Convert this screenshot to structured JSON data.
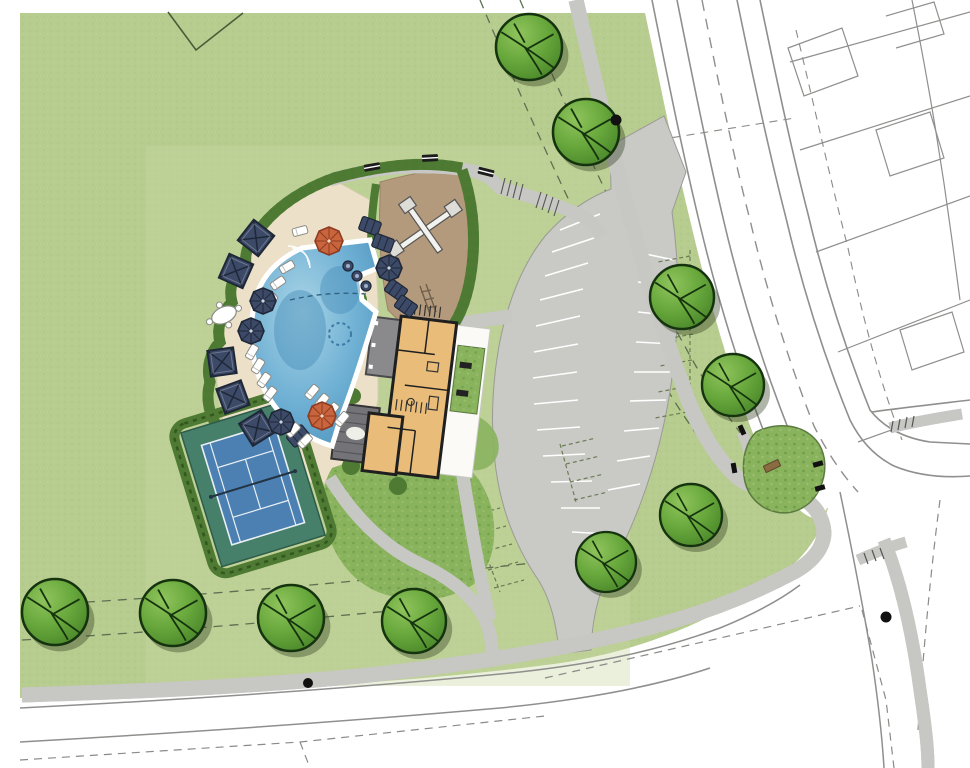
{
  "document": {
    "type": "color site plan rendering",
    "title": "Amenity center site plan",
    "visible_text": []
  },
  "colors": {
    "paper": "#ffffff",
    "grass": "#b7cc8f",
    "grass_light": "#c9d8a4",
    "grass_speckle": "#9fb377",
    "mound": "#8ab35e",
    "mound_dark": "#5e8e3a",
    "hedge": "#4e7a33",
    "hedge_dark": "#2c4f1a",
    "tree_fill": "#68a83c",
    "tree_light": "#8fc45c",
    "tree_dark": "#4d8a2c",
    "tree_outline": "#16330f",
    "tree_shadow": "rgba(45,60,30,0.38)",
    "deck": "#ece1c8",
    "mulch": "#b49a7c",
    "pool_light": "#a9d4e6",
    "pool_mid": "#6fb0d4",
    "pool_dark": "#4e93bd",
    "coping": "#ffffff",
    "parking": "#c9c9c6",
    "stripe": "#ffffff",
    "stall_dash": "#6b7c55",
    "road_line": "#8f8f8d",
    "walk": "#fbfaf6",
    "walk_edge": "#c7c7c3",
    "walk_dot": "#8f8f88",
    "floor": "#e9bd79",
    "wall": "#1f1f1f",
    "roof_gray": "#8a8a8c",
    "pergola_gray": "#737378",
    "navy": "#3c4a68",
    "navy_dark": "#1f2838",
    "orange": "#c9653c",
    "orange_dark": "#8e3b22",
    "court_apron": "#47806a",
    "court_surface": "#4d80b2",
    "court_line": "#e8f0f4",
    "bench_dark": "#1c1c1c",
    "bench_brown": "#8a6b42",
    "dot_black": "#111111"
  },
  "features": {
    "site": "community amenity center on a corner lot",
    "elements": [
      "free-form swimming pool with tanning shelf and entry steps",
      "clubhouse floor plan with covered porch and pergola",
      "playground with mulch surface and play structure",
      "tennis court with hedge enclosure",
      "curved pool deck with cabanas, umbrellas and loungers",
      "parking lot with striped stalls and dashed future stalls",
      "perimeter sidewalks with stipple texture",
      "street network with dashed centerlines and lot lines",
      "corner landscape bed with bench",
      "street trees"
    ],
    "counts": {
      "trees": 10,
      "cabanas": 5,
      "navy_umbrellas": 4,
      "orange_umbrellas": 2,
      "path_benches": 3,
      "in_pool_round_loungers": 3,
      "tennis_courts": 1
    }
  },
  "scene": {
    "trees": [
      {
        "x": 529,
        "y": 47,
        "r": 33
      },
      {
        "x": 586,
        "y": 132,
        "r": 33
      },
      {
        "x": 682,
        "y": 297,
        "r": 32
      },
      {
        "x": 733,
        "y": 385,
        "r": 31
      },
      {
        "x": 691,
        "y": 515,
        "r": 31
      },
      {
        "x": 606,
        "y": 562,
        "r": 30
      },
      {
        "x": 55,
        "y": 612,
        "r": 33
      },
      {
        "x": 173,
        "y": 613,
        "r": 33
      },
      {
        "x": 291,
        "y": 618,
        "r": 33
      },
      {
        "x": 414,
        "y": 621,
        "r": 32
      }
    ],
    "cabanas": [
      {
        "x": 256,
        "y": 238,
        "rot": 38
      },
      {
        "x": 236,
        "y": 271,
        "rot": 24
      },
      {
        "x": 222,
        "y": 362,
        "rot": -8
      },
      {
        "x": 233,
        "y": 397,
        "rot": -20
      },
      {
        "x": 257,
        "y": 428,
        "rot": -32
      }
    ],
    "navy_umbrellas": [
      {
        "x": 263,
        "y": 301
      },
      {
        "x": 251,
        "y": 331
      },
      {
        "x": 389,
        "y": 268
      },
      {
        "x": 281,
        "y": 422
      }
    ],
    "orange_umbrellas": [
      {
        "x": 329,
        "y": 241
      },
      {
        "x": 322,
        "y": 416
      }
    ],
    "navy_loungers": [
      {
        "x": 370,
        "y": 226,
        "rot": 20
      },
      {
        "x": 383,
        "y": 243,
        "rot": 20
      },
      {
        "x": 396,
        "y": 290,
        "rot": 35
      },
      {
        "x": 406,
        "y": 306,
        "rot": 35
      },
      {
        "x": 298,
        "y": 436,
        "rot": -40
      }
    ],
    "white_loungers": [
      {
        "x": 300,
        "y": 231,
        "rot": -15
      },
      {
        "x": 287,
        "y": 267,
        "rot": -30
      },
      {
        "x": 278,
        "y": 283,
        "rot": -35
      },
      {
        "x": 270,
        "y": 300,
        "rot": -40
      },
      {
        "x": 252,
        "y": 352,
        "rot": -60
      },
      {
        "x": 258,
        "y": 366,
        "rot": -58
      },
      {
        "x": 264,
        "y": 380,
        "rot": -55
      },
      {
        "x": 270,
        "y": 394,
        "rot": -52
      },
      {
        "x": 293,
        "y": 430,
        "rot": -45
      },
      {
        "x": 305,
        "y": 441,
        "rot": -45
      },
      {
        "x": 312,
        "y": 392,
        "rot": -50
      },
      {
        "x": 322,
        "y": 401,
        "rot": -50
      },
      {
        "x": 332,
        "y": 410,
        "rot": -50
      },
      {
        "x": 342,
        "y": 419,
        "rot": -50
      }
    ],
    "pool_round_loungers": [
      {
        "x": 348,
        "y": 266
      },
      {
        "x": 357,
        "y": 276
      },
      {
        "x": 366,
        "y": 286
      }
    ],
    "path_benches": [
      {
        "x": 372,
        "y": 167,
        "rot": -10
      },
      {
        "x": 430,
        "y": 158,
        "rot": -3
      },
      {
        "x": 486,
        "y": 172,
        "rot": 14
      }
    ],
    "black_dots": [
      {
        "x": 616,
        "y": 120,
        "s": 1.1
      },
      {
        "x": 308,
        "y": 683,
        "s": 1.0
      },
      {
        "x": 886,
        "y": 617,
        "s": 1.1
      }
    ]
  }
}
